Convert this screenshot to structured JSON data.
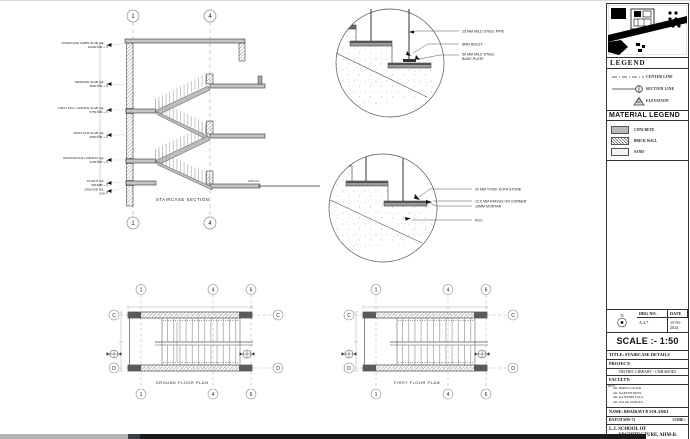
{
  "section": {
    "title": "STAIRCASE SECTION",
    "grids": [
      "1",
      "4"
    ],
    "ground_note": "0.00 LVL",
    "levels": [
      {
        "label": "STAIRCASE CABIN SLAB LVL.",
        "value": "12900 MM +"
      },
      {
        "label": "TERRACE SLAB LVL.",
        "value": "9600 MM +"
      },
      {
        "label": "FIRST FLR. LANDING SLAB LVL.",
        "value": "5750 MM +"
      },
      {
        "label": "FIRST FLR SLAB LVL.",
        "value": "4050 MM +"
      },
      {
        "label": "GROUND FLR LANDING LVL.",
        "value": "2100 MM +"
      },
      {
        "label": "PLINTH LVL.",
        "value": "300 MM +"
      },
      {
        "label": "GROUND LVL.",
        "value": "0.00"
      }
    ]
  },
  "detail_top": {
    "labels": [
      "25 MM MILD STEEL PIPE",
      "8MM BOULT",
      "50 MM MILD STEEL",
      "BASE PLATE"
    ]
  },
  "detail_mid": {
    "labels": [
      "20 MM THICK KOTA STONE",
      "12.5 MM RADIUS ON CORNER",
      "10MM MORTAR",
      "RCC"
    ]
  },
  "plans": {
    "grid_cols": [
      "1",
      "4",
      "6"
    ],
    "grid_rows": [
      "C",
      "D"
    ],
    "ground_title": "GROUND FLOOR PLAN",
    "first_title": "FIRST FLOOR PLAN"
  },
  "panel": {
    "legend_title": "LEGEND",
    "legend_items": [
      "CENTER LINE",
      "SECTION LINE",
      "ELEVATION"
    ],
    "material_title": "MATERIAL LEGEND",
    "material_items": [
      "CONCRETE",
      "BRICK WALL",
      "SAND"
    ],
    "titleblock": {
      "drg_no_label": "DRG NO.",
      "drg_no": "A.4.7",
      "date_label": "DATE",
      "date": "15-03-2024",
      "north_letter": "N",
      "scale": "SCALE :- 1:50",
      "title": "TITLE: STAIRCASE DETAILS",
      "project_label": "PROJECT:",
      "project": "DISTRIC LIBRARY - CHHARODI",
      "faculty_label": "FACULTY:",
      "faculty_note": "PROF.",
      "faculty": [
        "AR. HIREN GAJJAR",
        "AR. NARESH PATEL",
        "AR. RAJESHRI ZALA",
        "AR. PALAK PANDYA"
      ],
      "name": "NAME: BHAIRAVI D SOLANKI",
      "batch": "BATCH SDS-71",
      "code": "CODE:-",
      "school_line1": "L.J. SCHOOL OF",
      "school_line2": "ARCHITECTURE, AHM-B."
    }
  }
}
